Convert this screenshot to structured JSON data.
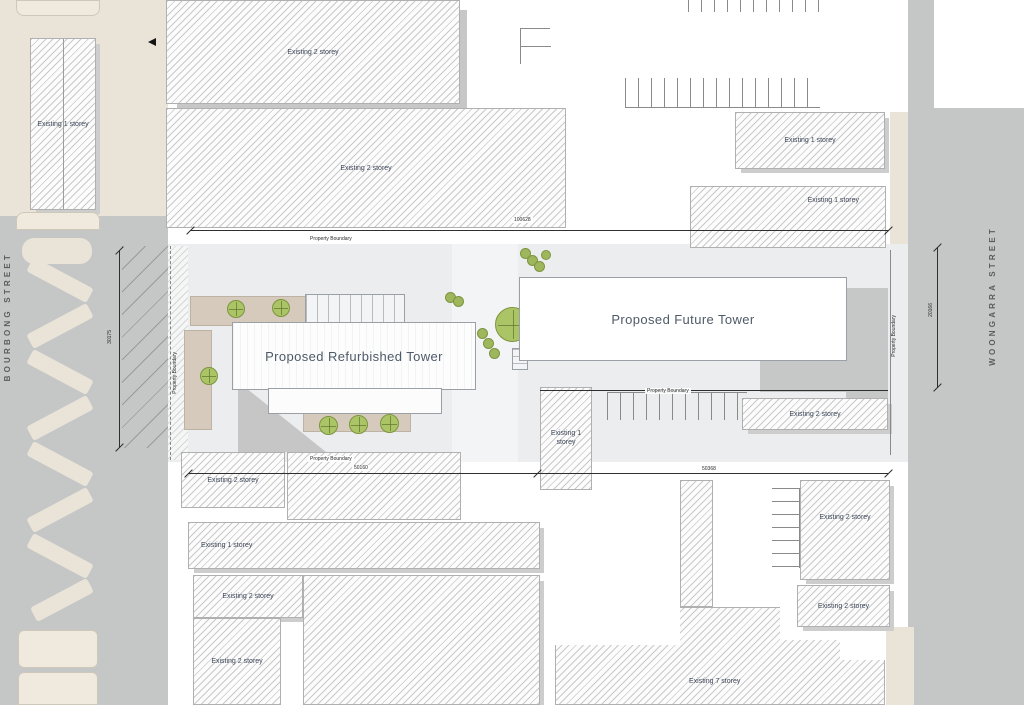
{
  "plan": {
    "streets": [
      {
        "name": "BOURBONG STREET"
      },
      {
        "name": "WOONGARRA STREET"
      }
    ],
    "towers": {
      "refurbished": "Proposed Refurbished Tower",
      "future": "Proposed Future Tower"
    },
    "boundary_label": "Property Boundary",
    "dimensions": {
      "top": "100628",
      "left": "30175",
      "right": "20166",
      "bottom_left": "50160",
      "bottom_right": "50368"
    },
    "buildings": [
      {
        "id": "nw",
        "label": "Existing 1 storey"
      },
      {
        "id": "top-a",
        "label": "Existing 2 storey"
      },
      {
        "id": "top-b",
        "label": "Existing 2 storey"
      },
      {
        "id": "ne-upper",
        "label": "Existing 1 storey"
      },
      {
        "id": "ne-lower",
        "label": "Existing 1 storey"
      },
      {
        "id": "center",
        "label": "Existing 1 storey"
      },
      {
        "id": "mid-east",
        "label": "Existing 2 storey"
      },
      {
        "id": "sw",
        "label": "Existing 2 storey"
      },
      {
        "id": "south-strip",
        "label": "Existing 1 storey"
      },
      {
        "id": "south-a",
        "label": "Existing 2 storey"
      },
      {
        "id": "south-b",
        "label": "Existing 2 storey"
      },
      {
        "id": "east-a",
        "label": "Existing 2 storey"
      },
      {
        "id": "east-b",
        "label": "Existing 2 storey"
      },
      {
        "id": "south-east",
        "label": "Existing 7 storey"
      }
    ],
    "colors": {
      "road": "#c5c6c6",
      "footpath": "#e9e3d8",
      "plaza": "#ebedee",
      "tree": "#abc465",
      "paving": "#d5cabb",
      "label_text": "#3c4658"
    }
  }
}
